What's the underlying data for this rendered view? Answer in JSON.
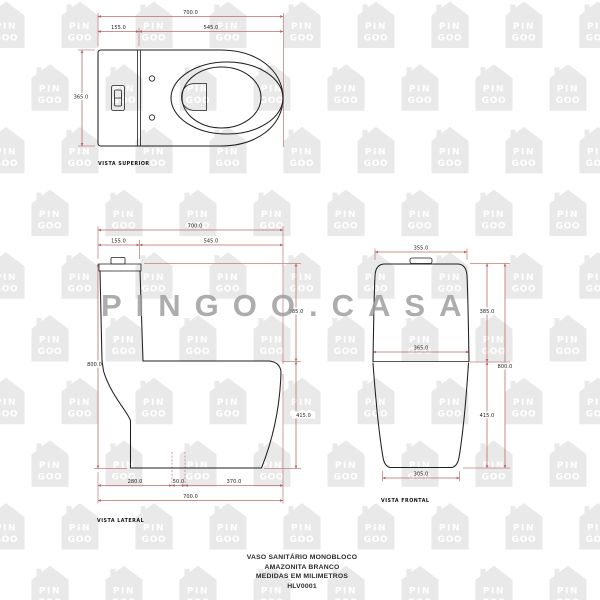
{
  "watermark": {
    "big_text": "PINGOO.CASA",
    "house_word_top": "PIN",
    "house_word_bottom": "GOO"
  },
  "colors": {
    "outline": "#1f1f1f",
    "dimension_lines": "#b96e6e",
    "watermark_house": "#e9e9e9",
    "watermark_text": "#9c9c9c"
  },
  "views": {
    "superior": {
      "label": "VISTA SUPERIOR",
      "dim_total_depth": "700.0",
      "dim_tank_depth": "155.0",
      "dim_seat_depth": "545.0",
      "dim_width": "365.0"
    },
    "lateral": {
      "label": "VISTA LATERAL",
      "dim_total_depth": "700.0",
      "dim_tank_depth": "155.0",
      "dim_seat_depth": "545.0",
      "dim_total_height": "800.0",
      "dim_tank_height": "385.0",
      "dim_bowl_height": "415.0",
      "dim_rear_to_trap": "280.0",
      "dim_trap_width": "50.0",
      "dim_trap_to_front": "370.0",
      "dim_total_depth_bottom": "700.0"
    },
    "frontal": {
      "label": "VISTA FRONTAL",
      "dim_tank_width": "355.0",
      "dim_bowl_width": "365.0",
      "dim_base_width": "305.0",
      "dim_tank_height": "385.0",
      "dim_bowl_height": "415.0",
      "dim_total_height": "800.0"
    }
  },
  "title_block": {
    "line1": "VASO SANITÁRIO MONOBLOCO",
    "line2": "AMAZONITA BRANCO",
    "line3": "MEDIDAS EM MILIMETROS",
    "line4": "HLV0001"
  }
}
